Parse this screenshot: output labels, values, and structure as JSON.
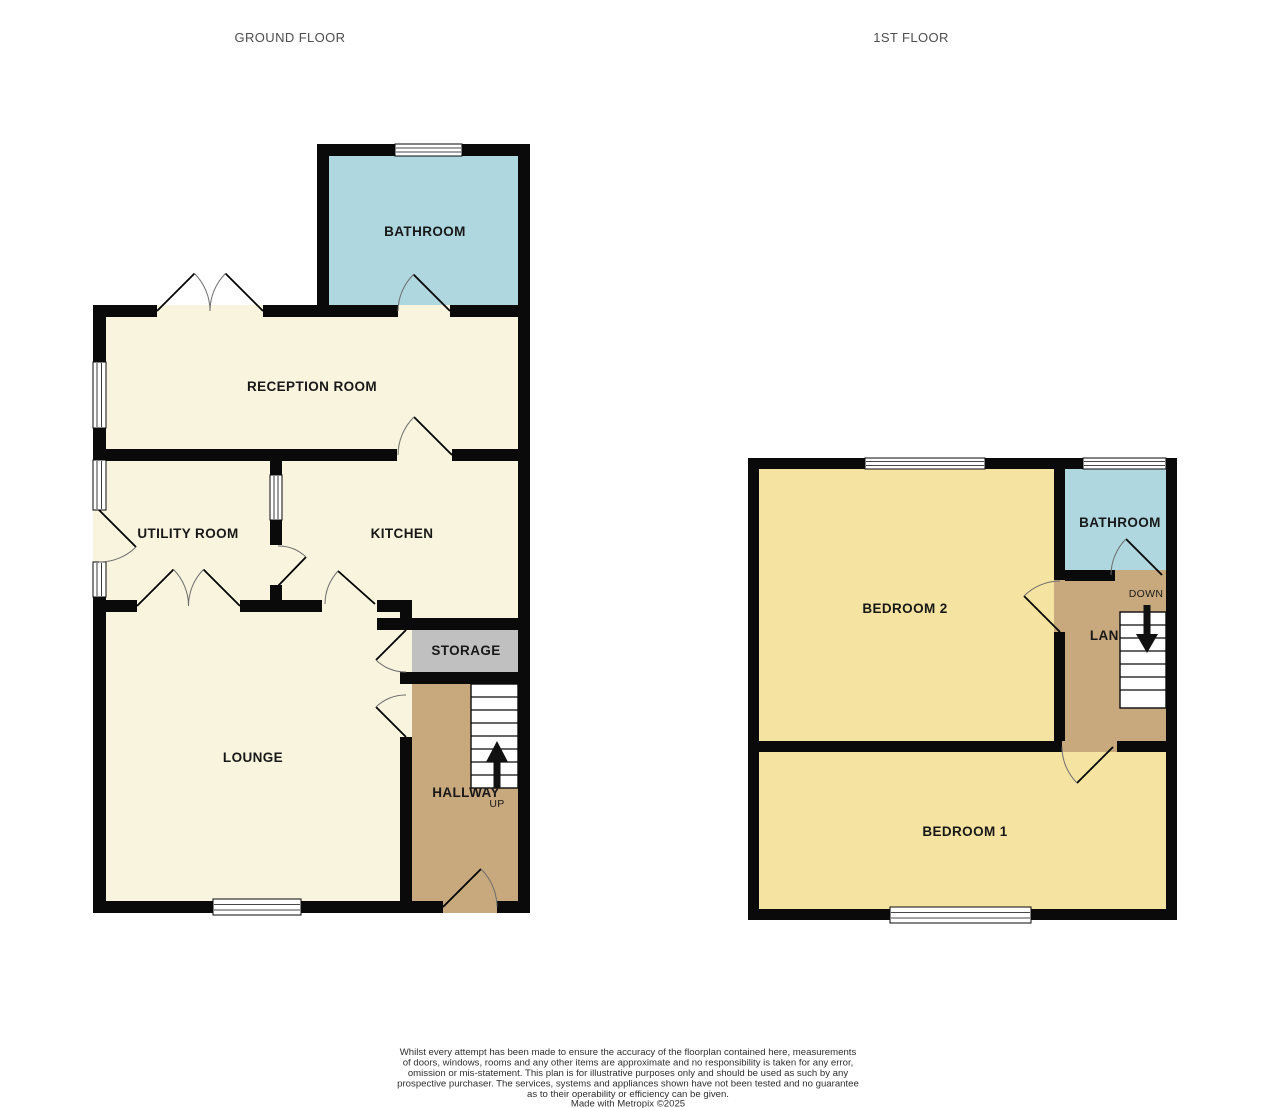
{
  "titles": {
    "ground_floor": "GROUND FLOOR",
    "first_floor": "1ST FLOOR"
  },
  "colors": {
    "wall": "#0a0a0a",
    "cream": "#f8f4de",
    "teal": "#aed7df",
    "yellow": "#f5e3a1",
    "tan": "#c8a97e",
    "gray": "#c1c0c0",
    "title_text": "#4d4d4d"
  },
  "ground_floor": {
    "rooms": {
      "bathroom": "BATHROOM",
      "reception_room": "RECEPTION ROOM",
      "utility_room": "UTILITY ROOM",
      "kitchen": "KITCHEN",
      "storage": "STORAGE",
      "lounge": "LOUNGE",
      "hallway": "HALLWAY"
    },
    "stairs_label": "UP"
  },
  "first_floor": {
    "rooms": {
      "bedroom_2": "BEDROOM 2",
      "bathroom": "BATHROOM",
      "landing": "LANDING",
      "bedroom_1": "BEDROOM 1"
    },
    "stairs_label": "DOWN"
  },
  "disclaimer": {
    "lines": [
      "Whilst every attempt has been made to ensure the accuracy of the floorplan contained here, measurements",
      "of doors, windows, rooms and any other items are approximate and no responsibility is taken for any error,",
      "omission or mis-statement. This plan is for illustrative purposes only and should be used as such by any",
      "prospective purchaser. The services, systems and appliances shown have not been tested and no guarantee",
      "as to their operability or efficiency can be given.",
      "Made with Metropix ©2025"
    ]
  }
}
